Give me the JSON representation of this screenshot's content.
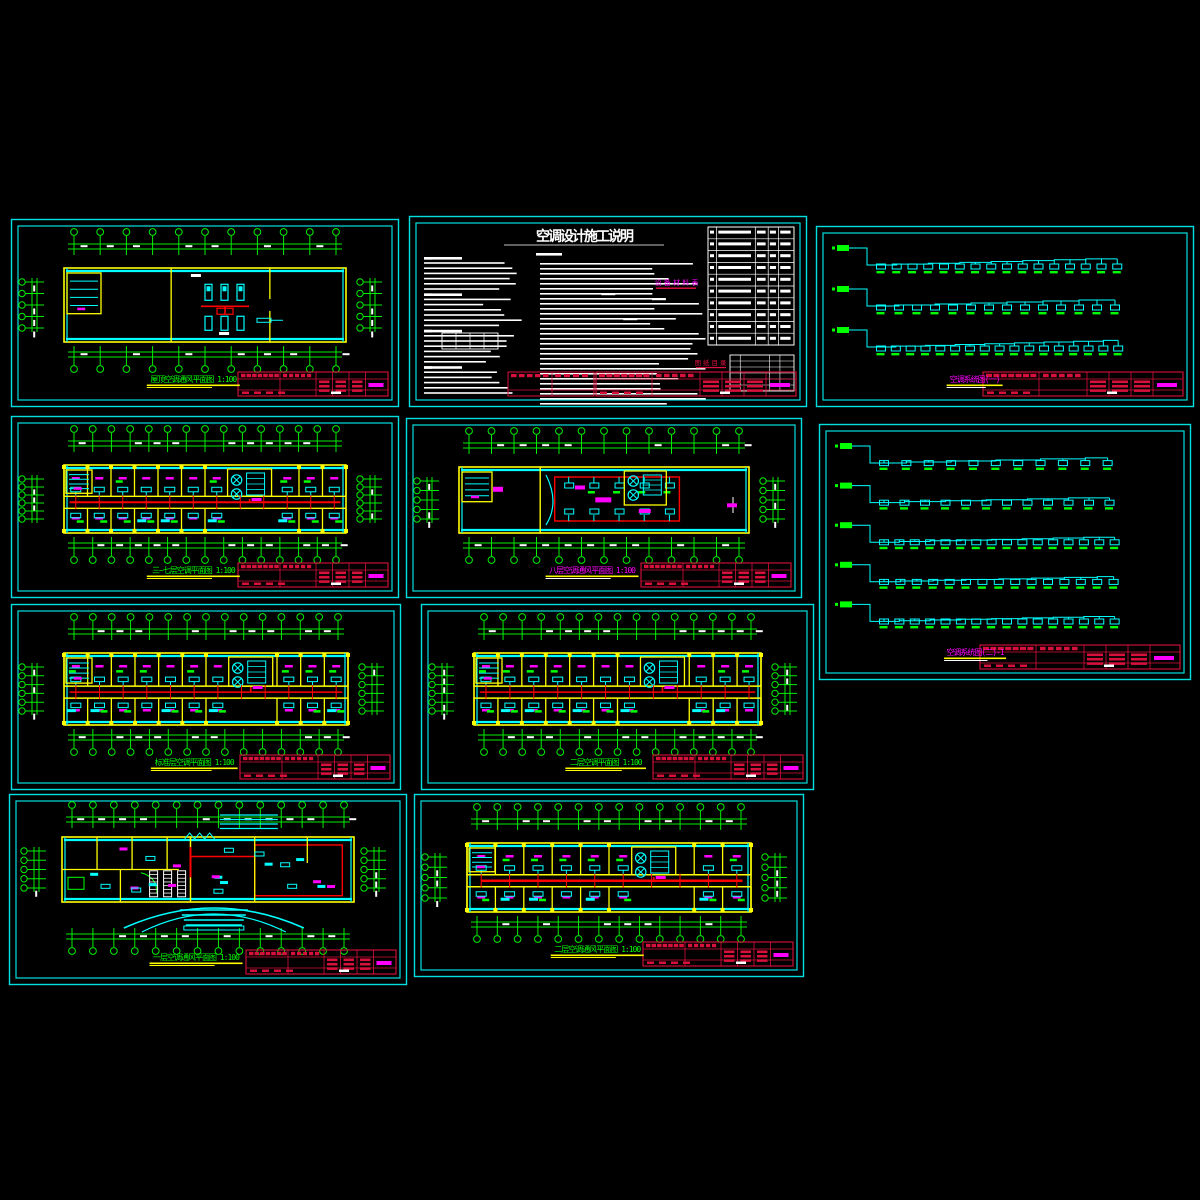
{
  "app": {
    "name": "cad-drawing-set",
    "background": "#000000"
  },
  "colors": {
    "frame": "#00e0e0",
    "grid": "#00ee00",
    "wall": "#ffff00",
    "band": "#00ffff",
    "pipe": "#ff0000",
    "label": "#ff00ff",
    "dim_text": "#ffffff",
    "title_green": "#00ff00",
    "title_magenta": "#ff00ff",
    "underline": "#ffff00",
    "title_block": "#d8113c",
    "notes_text": "#ffffff",
    "notes_red": "#e01040"
  },
  "notes_sheet": {
    "heading": "空调设计施工说明",
    "section_left_label": "一 设计说明",
    "section_mid_label": "二 施工说明",
    "equipment_table_heading": "设 备 材 料 表",
    "drawing_list_heading": "图 纸 目 录",
    "equipment_table": {
      "columns": 5,
      "rows": 10
    },
    "drawing_list_table": {
      "columns": 6,
      "rows": 8
    }
  },
  "panels": [
    {
      "id": "roof-plan",
      "type": "plan_sparse",
      "x": 10,
      "y": 218,
      "w": 390,
      "h": 190,
      "title": "屋顶空调通风平面图 1:100",
      "title_color": "#00ff00",
      "grid_cols": 10,
      "side_circles": 4
    },
    {
      "id": "notes",
      "type": "notes",
      "x": 408,
      "y": 215,
      "w": 400,
      "h": 193,
      "title": "空调设计施工说明",
      "title_color": "#ffffff"
    },
    {
      "id": "system-1",
      "type": "system",
      "x": 815,
      "y": 225,
      "w": 380,
      "h": 183,
      "title": "空调系统图(一)",
      "title_color": "#ff00ff",
      "branches": [
        16,
        14,
        17
      ]
    },
    {
      "id": "floor-3-7-plan",
      "type": "plan_dense",
      "x": 10,
      "y": 415,
      "w": 390,
      "h": 184,
      "title": "三~七层空调平面图 1:100",
      "title_color": "#00ff00",
      "grid_cols": 14,
      "side_circles": 5,
      "rooms_top": 12,
      "rooms_bottom": 12,
      "red_span": [
        0.02,
        0.98
      ],
      "red_w": 2
    },
    {
      "id": "floor-8-plan",
      "type": "plan_hall",
      "x": 405,
      "y": 417,
      "w": 398,
      "h": 182,
      "title": "八层空调通风平面图 1:100",
      "title_color": "#ff00ff",
      "grid_cols": 12,
      "side_circles": 4
    },
    {
      "id": "system-2",
      "type": "system",
      "x": 818,
      "y": 423,
      "w": 374,
      "h": 258,
      "title": "空调系统图(二)-1",
      "title_color": "#ff00ff",
      "branches": [
        11,
        12,
        16,
        15,
        16
      ]
    },
    {
      "id": "floor-std-plan",
      "type": "plan_dense",
      "x": 10,
      "y": 603,
      "w": 392,
      "h": 188,
      "title": "标准层空调平面图 1:100",
      "title_color": "#00ff00",
      "grid_cols": 14,
      "side_circles": 5,
      "rooms_top": 12,
      "rooms_bottom": 12,
      "red_span": [
        0.02,
        0.98
      ],
      "red_w": 1.6
    },
    {
      "id": "floor-2-plan",
      "type": "plan_dense",
      "x": 420,
      "y": 603,
      "w": 395,
      "h": 188,
      "title": "二层空调平面图 1:100",
      "title_color": "#00ff00",
      "grid_cols": 14,
      "side_circles": 5,
      "rooms_top": 12,
      "rooms_bottom": 12,
      "red_span": [
        0.02,
        0.98
      ],
      "red_w": 1.6
    },
    {
      "id": "floor-1-plan",
      "type": "plan_ground",
      "x": 8,
      "y": 793,
      "w": 400,
      "h": 193,
      "title": "一层空调通风平面图 1:100",
      "title_color": "#00ff00",
      "grid_cols": 13,
      "side_circles": 4
    },
    {
      "id": "floor-2-vent-plan",
      "type": "plan_dense",
      "x": 413,
      "y": 793,
      "w": 392,
      "h": 185,
      "title": "二层空调通风平面图 1:100",
      "title_color": "#00ff00",
      "grid_cols": 13,
      "side_circles": 4,
      "rooms_top": 10,
      "rooms_bottom": 10,
      "red_span": [
        0.05,
        0.97
      ],
      "red_w": 2.4
    }
  ]
}
